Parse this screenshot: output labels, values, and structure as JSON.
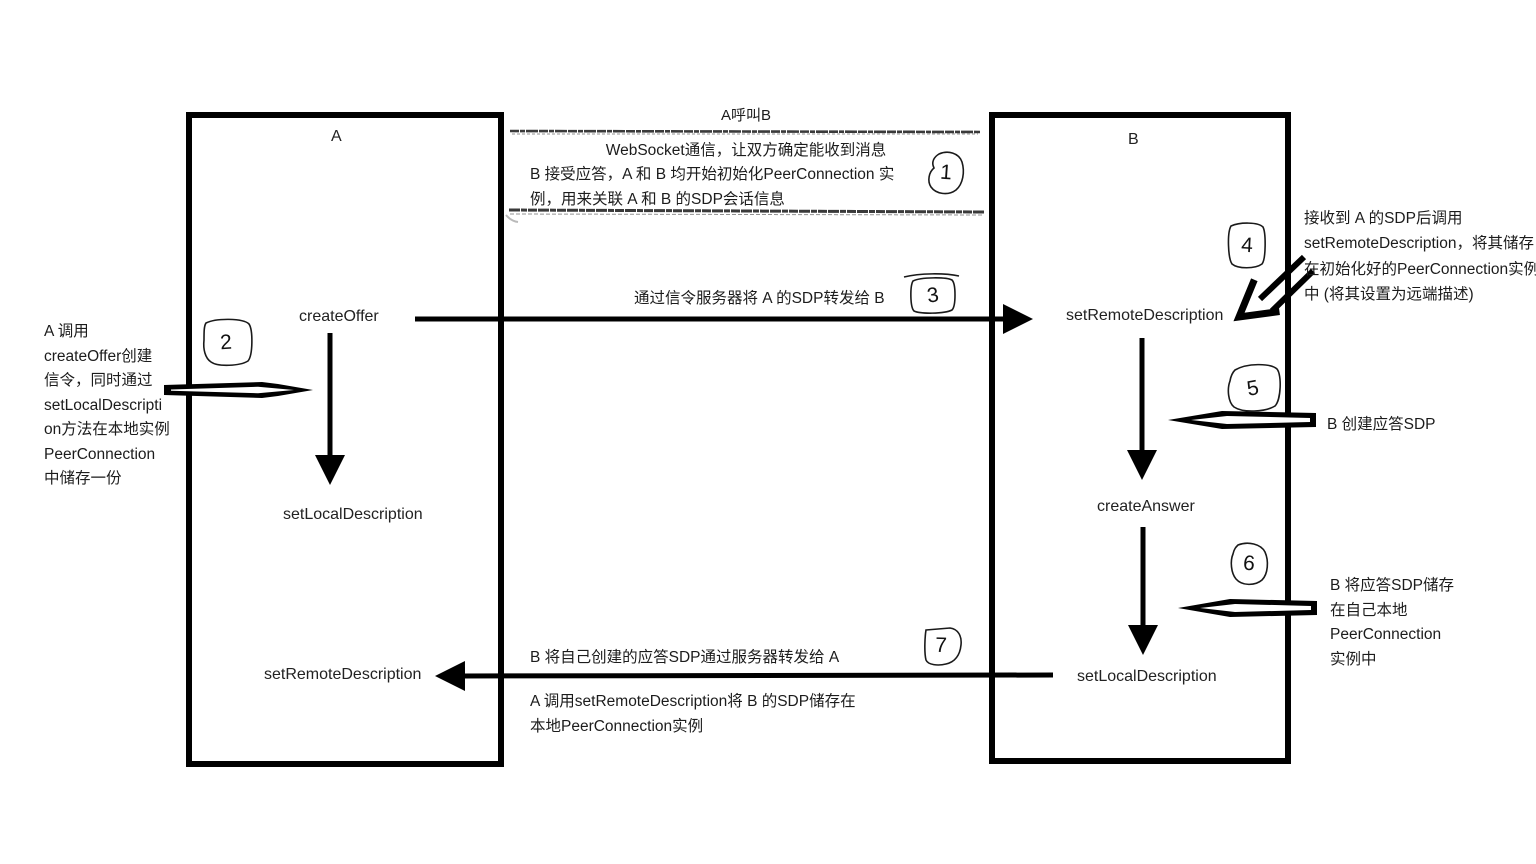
{
  "diagram_title": "A呼叫B",
  "boxes": {
    "a": {
      "label": "A",
      "methods": {
        "create_offer": "createOffer",
        "set_local": "setLocalDescription",
        "set_remote": "setRemoteDescription"
      }
    },
    "b": {
      "label": "B",
      "methods": {
        "set_remote": "setRemoteDescription",
        "create_answer": "createAnswer",
        "set_local": "setLocalDescription"
      }
    }
  },
  "steps": {
    "s1": {
      "badge": "1",
      "lines": [
        "WebSocket通信，让双方确定能收到消息",
        "B 接受应答，A 和 B 均开始初始化PeerConnection 实",
        "例，用来关联 A 和 B 的SDP会话信息"
      ]
    },
    "s2": {
      "badge": "2",
      "lines": [
        "A 调用",
        "createOffer创建",
        "信令，同时通过",
        "setLocalDescripti",
        "on方法在本地实例",
        "PeerConnection",
        "中储存一份"
      ]
    },
    "s3": {
      "badge": "3",
      "label": "通过信令服务器将 A 的SDP转发给 B"
    },
    "s4": {
      "badge": "4",
      "lines": [
        "接收到 A 的SDP后调用",
        "setRemoteDescription，将其储存",
        "在初始化好的PeerConnection实例",
        "中 (将其设置为远端描述)"
      ]
    },
    "s5": {
      "badge": "5",
      "label": "B 创建应答SDP"
    },
    "s6": {
      "badge": "6",
      "lines": [
        "B 将应答SDP储存",
        "在自己本地",
        "PeerConnection",
        "实例中"
      ]
    },
    "s7": {
      "badge": "7",
      "label": "B 将自己创建的应答SDP通过服务器转发给 A",
      "result_lines": [
        "A 调用setRemoteDescription将 B 的SDP储存在",
        "本地PeerConnection实例"
      ]
    }
  },
  "colors": {
    "ink": "#000000",
    "text": "#1c1c1c",
    "sketch": "#3a3a3a"
  }
}
